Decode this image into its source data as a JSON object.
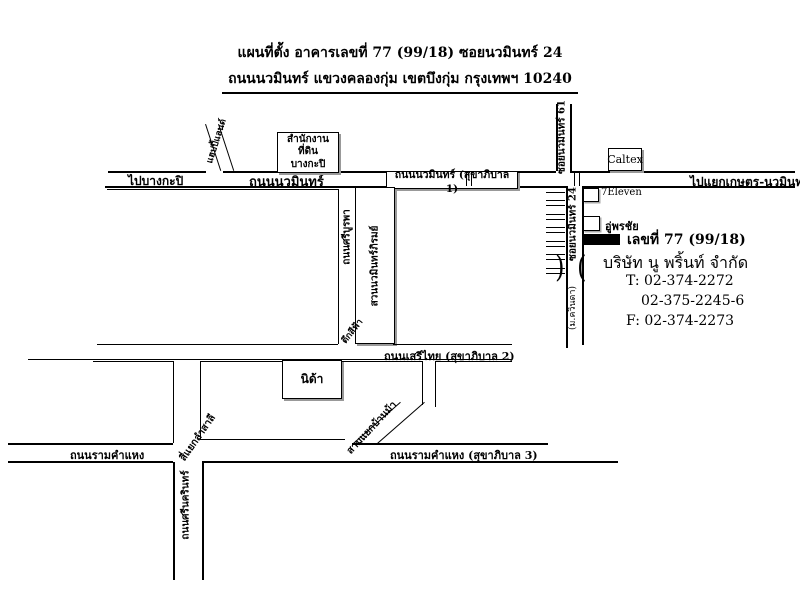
{
  "title": {
    "line1": "แผนที่ตั้ง อาคารเลขที่ 77 (99/18) ซอยนวมินทร์ 24",
    "line2": "ถนนนวมินทร์ แขวงคลองกุ่ม เขตบึงกุ่ม กรุงเทพฯ 10240"
  },
  "main_road": {
    "to_bangkapi": "ไปบางกะปิ",
    "name": "ถนนนวมินทร์",
    "boxed_name": "ถนนนวมินทร์ (สุขาภิบาล 1)",
    "to_kaset": "ไปแยกเกษตร-นวมินทร์"
  },
  "sois": {
    "soi61": "ซอยนวมินทร์ 61",
    "soi24": "ซอยนวมินทร์ 24",
    "village": "(ม.ควินดา)"
  },
  "roads": {
    "happyland": "แฮปปี้แลนด์",
    "sriburapha": "ถนนศรีบูรพา",
    "serithai": "ถนนเสรีไทย (สุขาภิบาล 2)",
    "ramkhamhaeng": "ถนนรามคำแหง",
    "ramkhamhaeng3": "ถนนรามคำแหง (สุขาภิบาล 3)",
    "srinakarin": "ถนนศรีนครินทร์"
  },
  "junctions": {
    "lamsali": "สี่แยกลำสาลี",
    "banma": "สามแยกบ้านม้า"
  },
  "landmarks": {
    "land_office_line1": "สำนักงานที่ดิน",
    "land_office_line2": "บางกะปิ",
    "caltex": "Caltex",
    "seven_eleven": "7Eleven",
    "garage": "อู่พรชัย",
    "park": "สวนนวมินทร์ภิรมย์",
    "blue_building": "ตึกสีฟ้า",
    "nida": "นิด้า"
  },
  "destination": {
    "address_label": "เลขที่ 77 (99/18)",
    "company": "บริษัท นู พริ้นท์ จำกัด",
    "tel1": "T: 02-374-2272",
    "tel2": "02-375-2245-6",
    "fax": "F: 02-374-2273"
  },
  "symbols": {
    "bridge_left": ")",
    "bridge_right": "("
  },
  "colors": {
    "line": "#000000",
    "background": "#ffffff",
    "building_fill": "#000000"
  }
}
